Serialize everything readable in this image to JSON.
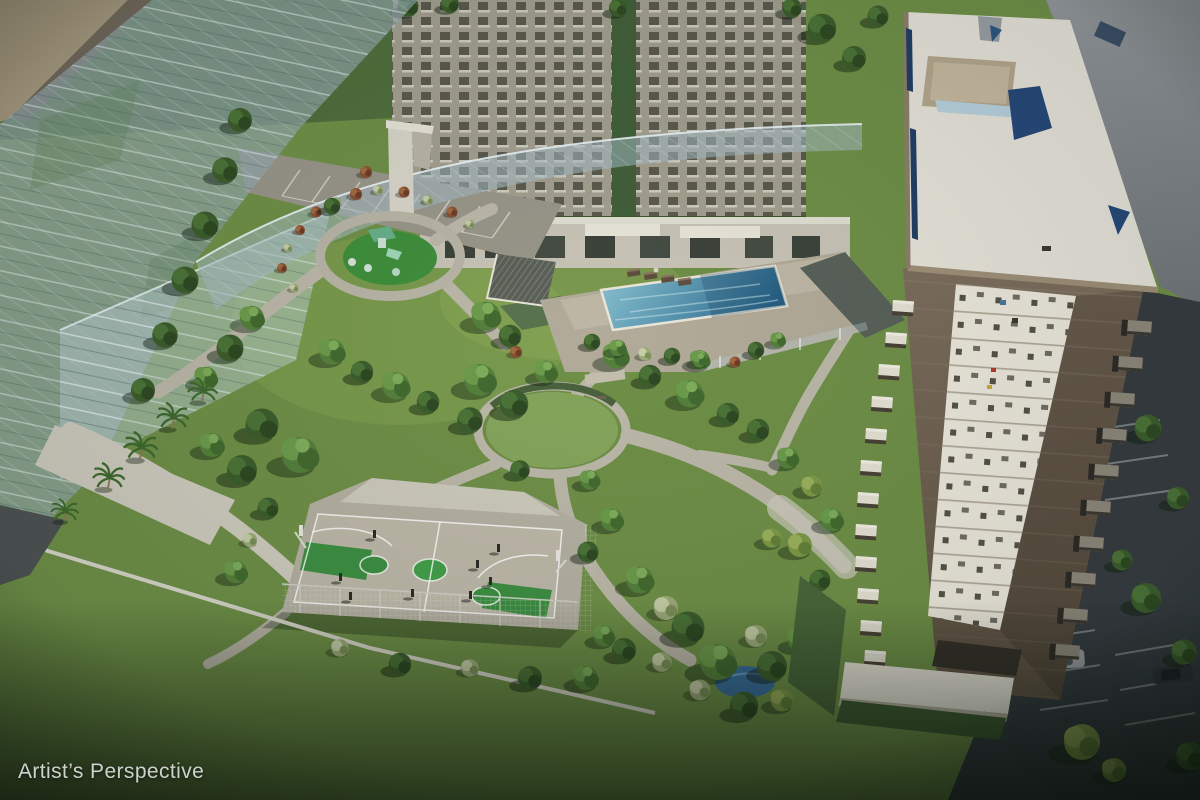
{
  "caption": {
    "text": "Artist’s Perspective"
  },
  "palette": {
    "grass": "#6f9048",
    "grass_dark": "#2c4526",
    "path": "#bcb8a9",
    "pool_light": "#8cc4d2",
    "pool_deep": "#2f6e92",
    "court_green": "#3e9043",
    "court_center": "#44a04a",
    "concrete": "#b5b1a3",
    "roof_white": "#e7e4da",
    "facade_brown": "#7e6f5e",
    "facade_white": "#ece8dc",
    "deck": "#b3ab99",
    "road": "#8a8e94",
    "asphalt_dark": "#363c41",
    "glass_tint": "#9db4bc"
  },
  "scene": {
    "kind": "aerial architectural rendering of a residential development",
    "features": [
      "translucent future building",
      "background towers",
      "playground",
      "pavilion",
      "swimming pool with lounge deck",
      "central lawn circle",
      "basketball court",
      "garden paths and trees",
      "residential tower",
      "parking areas"
    ]
  }
}
